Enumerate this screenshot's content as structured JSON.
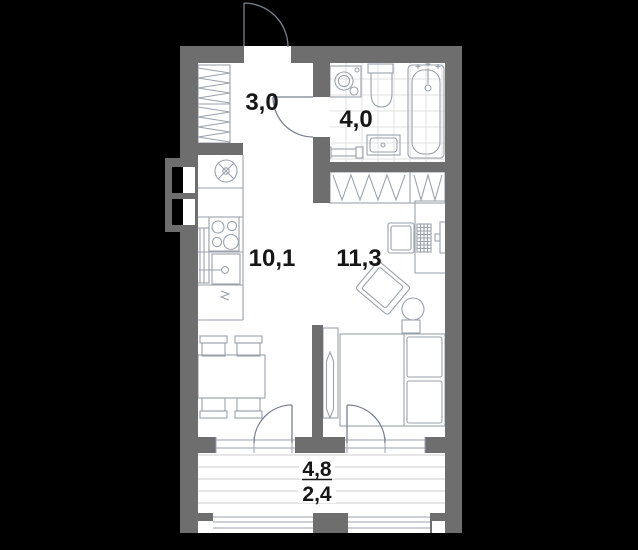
{
  "colors": {
    "background": "#000000",
    "wall": "#6e6e6e",
    "floor": "#ffffff",
    "furniture_line": "#9aa2ab",
    "door_line": "#7a8090",
    "tile_line": "#e2e2e2",
    "balcony_floor_line": "#d6d6d6",
    "label": "#161616"
  },
  "rooms": {
    "hallway": {
      "area": "3,0"
    },
    "bathroom": {
      "area": "4,0"
    },
    "kitchen_living": {
      "area": "10,1"
    },
    "living_room": {
      "area": "11,3"
    },
    "balcony": {
      "area_total": "4,8",
      "area_reduced": "2,4"
    }
  },
  "fixtures": [
    "entry-door",
    "closet",
    "washing-machine",
    "toilet",
    "bathtub",
    "shower-mixer",
    "bathroom-sink",
    "towel-rail",
    "vent-shaft",
    "kitchen-vent",
    "stove",
    "kitchen-sink",
    "dishwasher",
    "radiator",
    "dining-table",
    "dining-chair",
    "wardrobe",
    "desk",
    "monitor",
    "keyboard",
    "desk-chair",
    "armchair",
    "pouf",
    "bed",
    "nightstand",
    "sliding-door",
    "balcony-door",
    "window",
    "balcony-glazing"
  ]
}
